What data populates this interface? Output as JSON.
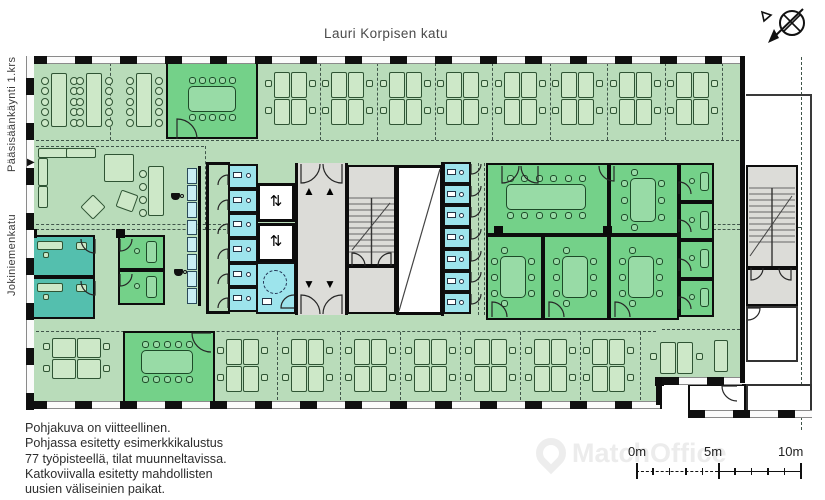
{
  "title": "Lauri Korpisen katu",
  "side_labels": {
    "main_entrance": "Pääsisäänkäynti 1.krs",
    "street_left": "Jokiniemenkatu"
  },
  "notes": [
    "Pohjakuva on viitteellinen.",
    "Pohjassa esitetty esimerkkikalustus",
    "77 työpisteellä, tilat muunneltavissa.",
    "Katkoviivalla esitetty mahdollisten",
    "uusien väliseinien paikat."
  ],
  "scale_bar": {
    "labels": [
      "0m",
      "5m",
      "10m"
    ]
  },
  "watermark": "MatchOffice",
  "icons": {
    "north_arrow": "compass-cross-arrow",
    "entrance_arrow": "▶",
    "elevator": "⇅",
    "up": "▲",
    "down": "▼",
    "right": "►",
    "coffee": "coffee-cup"
  },
  "colors": {
    "floor": "#b9dcba",
    "room_green": "#74d189",
    "room_teal": "#54bfae",
    "wc_cyan": "#9de4ec",
    "locker_cyan": "#c9eef4",
    "gray": "#dcdcd8",
    "wall": "#111111",
    "furniture_light": "#cde8c8",
    "furniture_green": "#98dba6",
    "furniture_teal": "#8fd8cc",
    "text": "#2d2d2d"
  }
}
